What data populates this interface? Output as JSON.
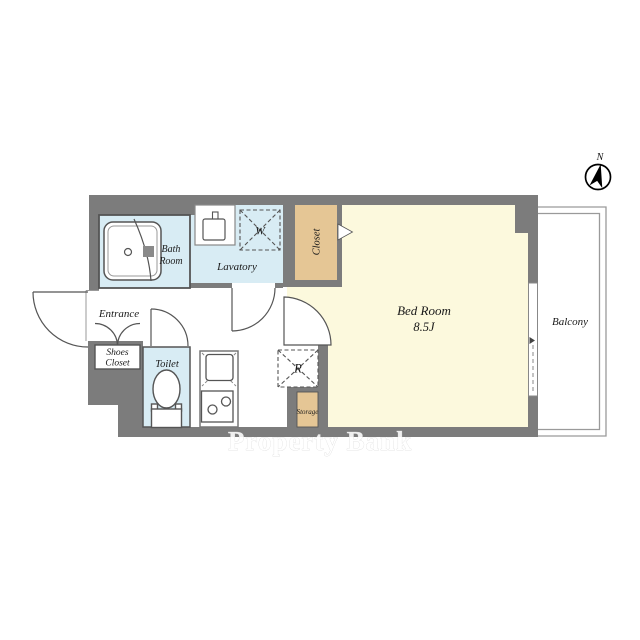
{
  "document": {
    "type": "apartment-floor-plan"
  },
  "compass": {
    "north_label": "N"
  },
  "watermark": {
    "text": "Property Bank"
  },
  "rooms": {
    "bath_room": {
      "line1": "Bath",
      "line2": "Room"
    },
    "lavatory": {
      "label": "Lavatory"
    },
    "closet": {
      "label": "Closet"
    },
    "bed_room": {
      "label": "Bed Room",
      "size": "8.5J"
    },
    "balcony": {
      "label": "Balcony"
    },
    "entrance": {
      "label": "Entrance"
    },
    "shoes_closet": {
      "line1": "Shoes",
      "line2": "Closet"
    },
    "toilet": {
      "label": "Toilet"
    },
    "storage": {
      "label": "Storage"
    }
  },
  "appliances": {
    "washing_machine": {
      "label": "W"
    },
    "refrigerator": {
      "label": "R"
    }
  },
  "colors": {
    "wall": "#7c7c7c",
    "wet_room": "#d8ecf4",
    "closet": "#e5c695",
    "bedroom": "#fcf9dd",
    "outline": "#555555",
    "balcony_line": "#9a9a9a"
  }
}
